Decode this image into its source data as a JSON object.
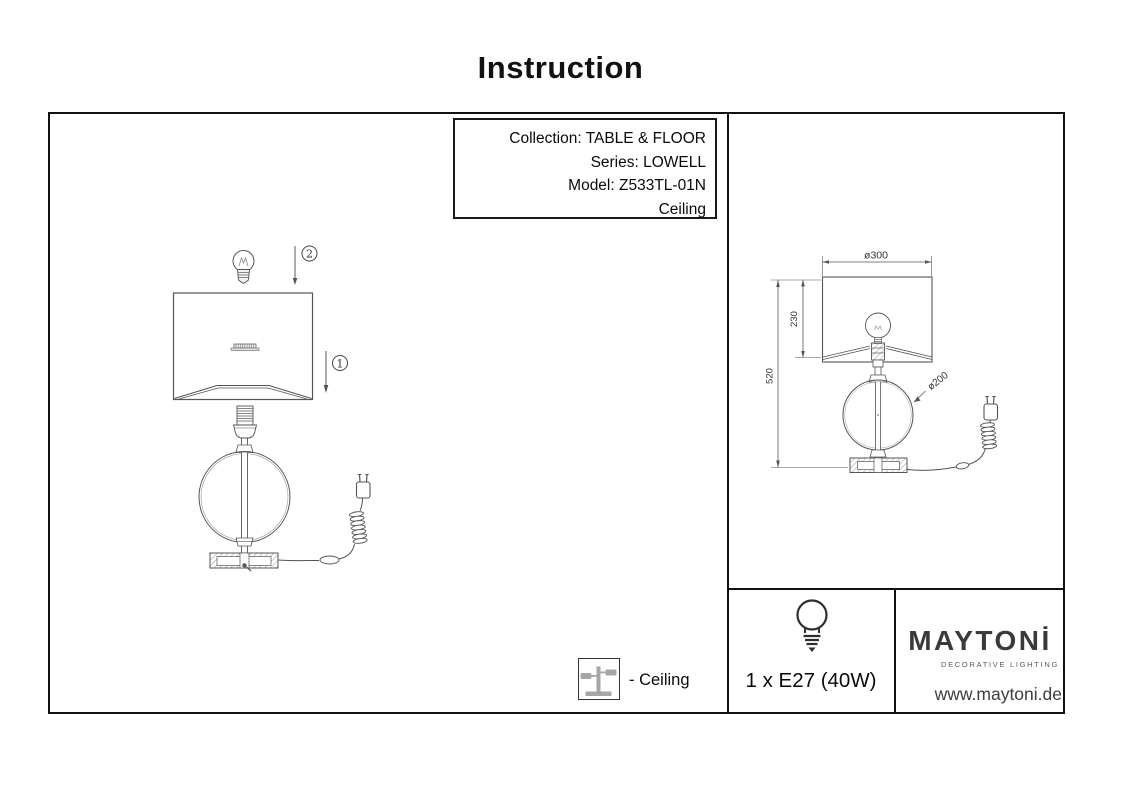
{
  "title": "Instruction",
  "info_box": {
    "lines": [
      "Collection: TABLE & FLOOR",
      "Series: LOWELL",
      "Model: Z533TL-01N",
      "Ceiling"
    ]
  },
  "assembly": {
    "step_shade": "1",
    "step_bulb": "2"
  },
  "dimensions": {
    "shade_diameter": "ø300",
    "shade_height": "230",
    "total_height": "520",
    "glass_diameter": "ø200"
  },
  "legend": {
    "label": "- Ceiling"
  },
  "spec": {
    "bulb": "1 x E27 (40W)"
  },
  "brand": {
    "name": "MAYTONİ",
    "tagline": "DECORATIVE LIGHTING",
    "website": "www.maytoni.de"
  },
  "colors": {
    "line": "#555555",
    "border": "#111111",
    "logo": "#3a3a3a",
    "icon_gray": "#a6a6a6"
  }
}
